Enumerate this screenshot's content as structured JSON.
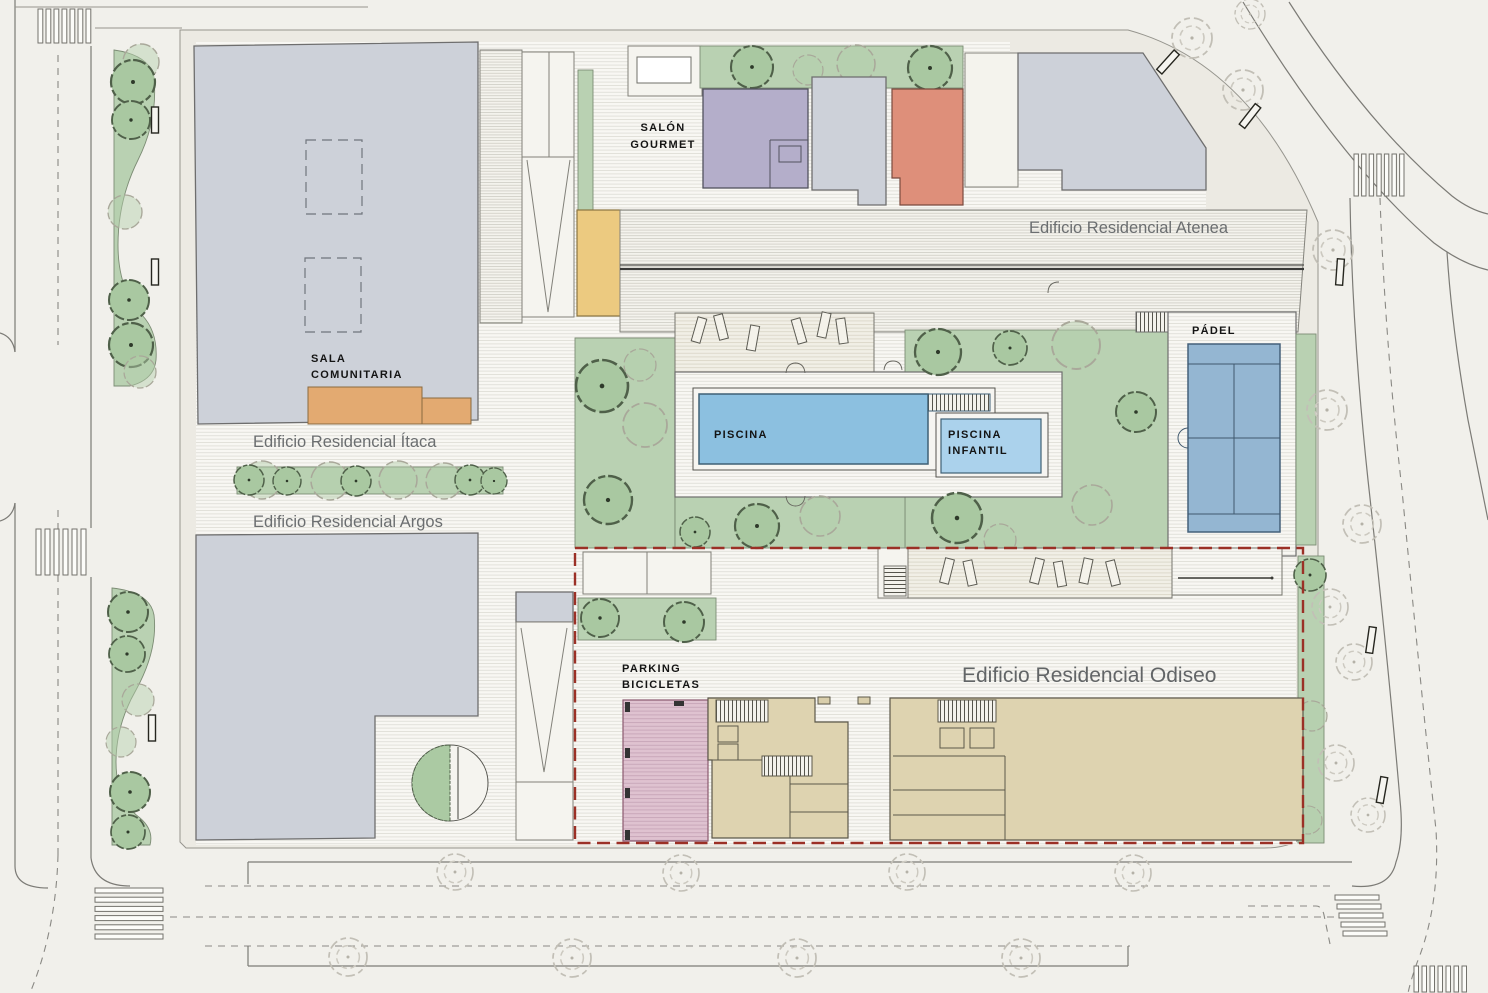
{
  "labels": {
    "itaca": "Edificio Residencial Ítaca",
    "argos": "Edificio Residencial Argos",
    "atenea": "Edificio Residencial Atenea",
    "odiseo": "Edificio Residencial Odiseo",
    "sala_1": "SALA",
    "sala_2": "COMUNITARIA",
    "salon_1": "SALÓN",
    "salon_2": "GOURMET",
    "gimnasio": "GIMNASIO",
    "juegos_1": "JUEGOS",
    "juegos_2": "INFANTILES",
    "piscina": "PISCINA",
    "piscina_inf_1": "PISCINA",
    "piscina_inf_2": "INFANTIL",
    "padel": "PÁDEL",
    "parking_1": "PARKING",
    "parking_2": "BICICLETAS"
  },
  "colors": {
    "background": "#f1f0eb",
    "building_gray": "#cdd1d9",
    "green_area": "#b9d1b2",
    "pool_blue": "#8cc0e0",
    "pool_infant_blue": "#abd2ec",
    "padel_blue": "#94b6d2",
    "salon_gourmet_purple": "#b4aeca",
    "gimnasio_salmon": "#de8f7a",
    "juegos_yellow": "#ecca80",
    "sala_orange": "#e3aa71",
    "parking_pink": "#dfc2d0",
    "unit_beige": "#ded3b0",
    "boundary_red": "#9b3026"
  }
}
